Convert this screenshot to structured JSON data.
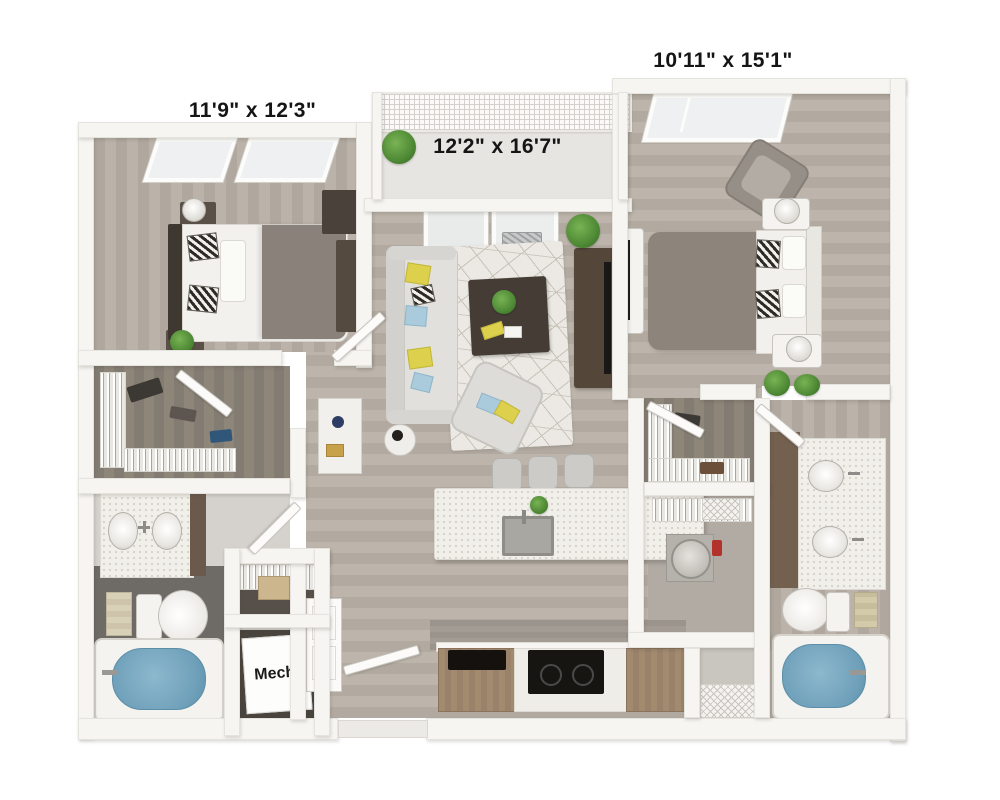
{
  "plan": {
    "type": "apartment-floor-plan-3d",
    "rooms": [
      {
        "name": "bedroom-left",
        "dims": "11'9\" x 12'3\""
      },
      {
        "name": "living-room",
        "dims": "12'2\" x 16'7\""
      },
      {
        "name": "bedroom-right",
        "dims": "10'11\" x 15'1\""
      },
      {
        "name": "mechanical-closet",
        "label": "Mech."
      }
    ],
    "colors": {
      "background": "#ffffff",
      "wall": "#f6f5f2",
      "wood_floor": "#b7afa5",
      "closet_floor": "#8a8379",
      "tub_water": "#6fa0ba",
      "cabinet_brown": "#a28a6f",
      "dark_furniture": "#4a423a",
      "accent_yellow": "#ddd04c",
      "accent_blue": "#aacbdc",
      "plant_green": "#4d8834",
      "label_text": "#151515"
    }
  }
}
